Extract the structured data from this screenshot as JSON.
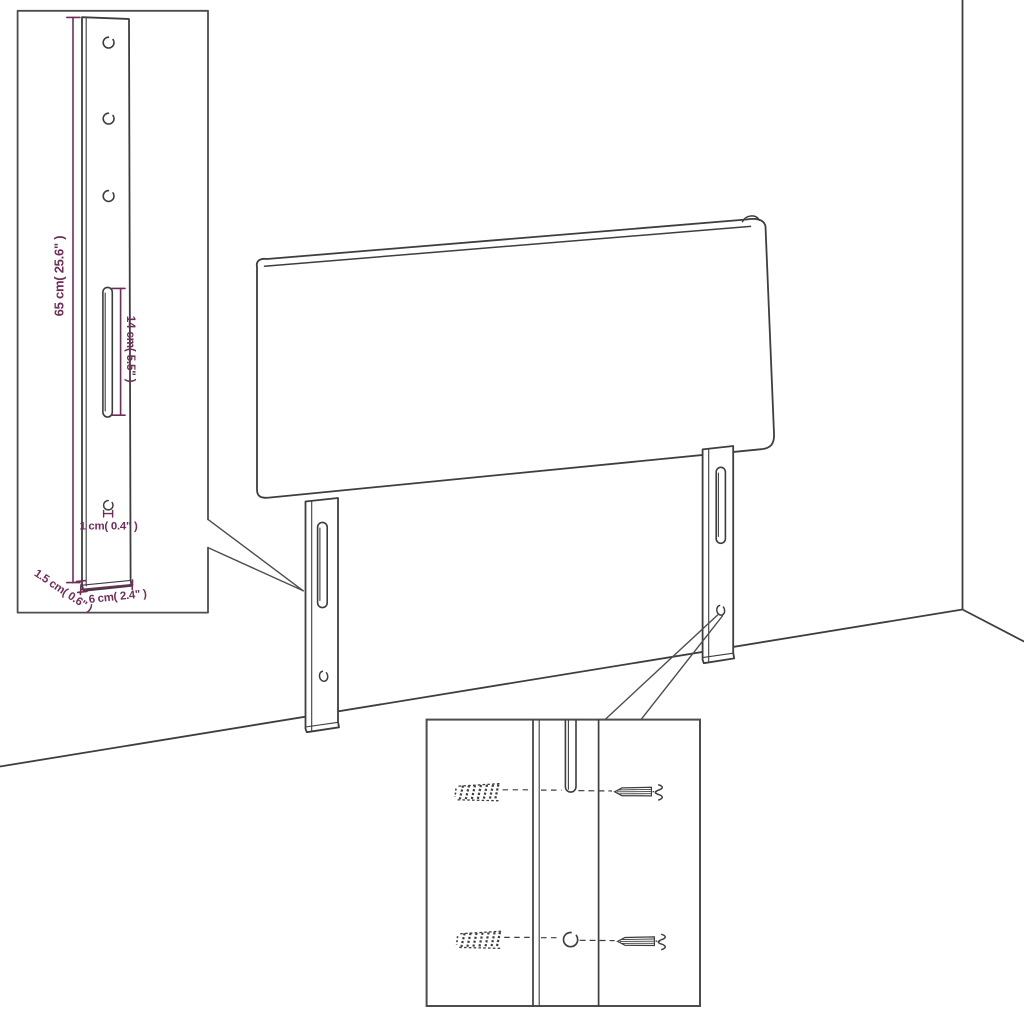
{
  "colors": {
    "line": "#3e3e3e",
    "callout": "#4d4d4d",
    "dimension": "#712d5a",
    "surface": "#ffffff"
  },
  "labels": {
    "leg_height": "65 cm( 25.6\" )",
    "slot_length": "14 cm( 5.5\" )",
    "hole_diameter": "1 cm( 0.4\" )",
    "leg_width": "6 cm( 2.4\" )",
    "leg_thickness": "1.5 cm( 0.6\" )"
  },
  "icons": {
    "wall_anchor": "wall-anchor-icon",
    "screw": "screw-icon"
  }
}
